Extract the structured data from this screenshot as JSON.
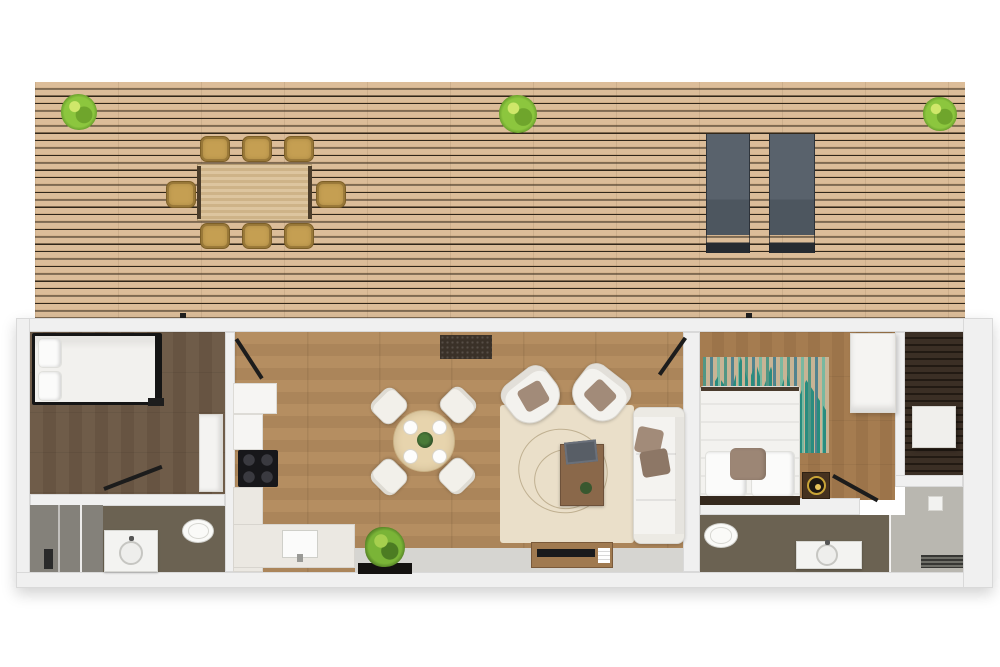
{
  "scene": {
    "label": "3D floor plan - top view",
    "description": "Rendered top-down plan of a long narrow home with a large wooden roof deck, two bedrooms, two bathrooms, kitchen and living-dining room"
  },
  "palette": {
    "page_bg": "#ffffff",
    "deck_wood": "#dcbd99",
    "deck_gap": "#31271a",
    "shrub_green": "#8cc63e",
    "deck_chair": "#c59f52",
    "table_deck": "#d8bd92",
    "lounger_gray": "#59626c",
    "wall": "#f0f0f0",
    "wall_edge": "#d9d9d9",
    "floor_living": "#b58e61",
    "floor_bedroom1": "#6f5c49",
    "floor_bedroom2": "#a57c50",
    "floor_bath": "#6b6252",
    "dark_deck": "#3b2f25",
    "rug_cream": "#eadfc9",
    "rug_teal": "#2a8c7f",
    "table_round": "#e7d4ad",
    "pillow_taupe": "#a28b79",
    "furniture_wood": "#8a684a"
  },
  "deck": {
    "label": "Roof terrace deck",
    "items": [
      {
        "name": "outdoor-dining-table",
        "label": "Outdoor dining table"
      },
      {
        "name": "outdoor-dining-chairs",
        "label": "Outdoor dining chairs",
        "count": 8
      },
      {
        "name": "sun-loungers",
        "label": "Sun loungers",
        "count": 2
      },
      {
        "name": "shrubs",
        "label": "Green shrubs",
        "count": 3
      }
    ]
  },
  "rooms": [
    {
      "name": "bedroom-1",
      "label": "Bedroom 1",
      "items": [
        "double bed with black frame",
        "wardrobe",
        "swing door"
      ]
    },
    {
      "name": "bathroom-1",
      "label": "Bathroom 1",
      "items": [
        "walk-in shower",
        "washbasin vanity",
        "toilet"
      ]
    },
    {
      "name": "kitchen",
      "label": "Kitchen",
      "items": [
        "tall cabinet",
        "cooktop with 4 burners",
        "L-shaped counter",
        "kitchen sink"
      ]
    },
    {
      "name": "living-dining",
      "label": "Living / dining room",
      "items": [
        "round dining table with 4 place settings",
        "4 dining chairs",
        "cream area rug",
        "2 armchairs",
        "sofa",
        "coffee table",
        "laptop",
        "media console with TV",
        "2 doormats",
        "potted plant"
      ]
    },
    {
      "name": "bedroom-2",
      "label": "Bedroom 2",
      "items": [
        "double bed",
        "teal striped rug",
        "wardrobe",
        "nightstand with lamp",
        "swing door"
      ]
    },
    {
      "name": "bathroom-2",
      "label": "Bathroom 2",
      "items": [
        "toilet",
        "washbasin vanity",
        "walk-in shower with drain"
      ]
    },
    {
      "name": "side-terrace",
      "label": "Side terrace",
      "items": [
        "dark slatted decking",
        "white side table"
      ]
    }
  ]
}
